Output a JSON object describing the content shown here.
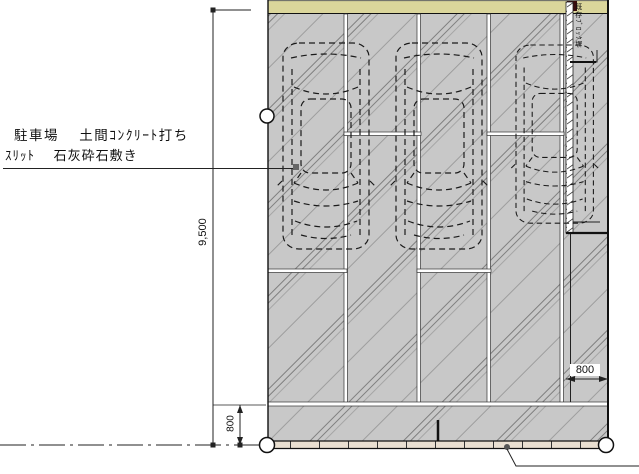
{
  "plan": {
    "area_label_line1": "駐車場　 土間ｺﾝｸﾘｰﾄ打ち",
    "area_label_line2": "ｽﾘｯﾄ　 石灰砕石敷き",
    "right_wall_label": "既存ﾌﾞﾛｯｸ塀",
    "dim_total_height": "9,500",
    "dim_bottom_offset": "800",
    "dim_right_offset": "800",
    "colors": {
      "concrete": "#c8c8c8",
      "hedge": "#dbd69b",
      "curb": "#e9dfd1",
      "hatch_line": "#7f7f7f"
    }
  }
}
